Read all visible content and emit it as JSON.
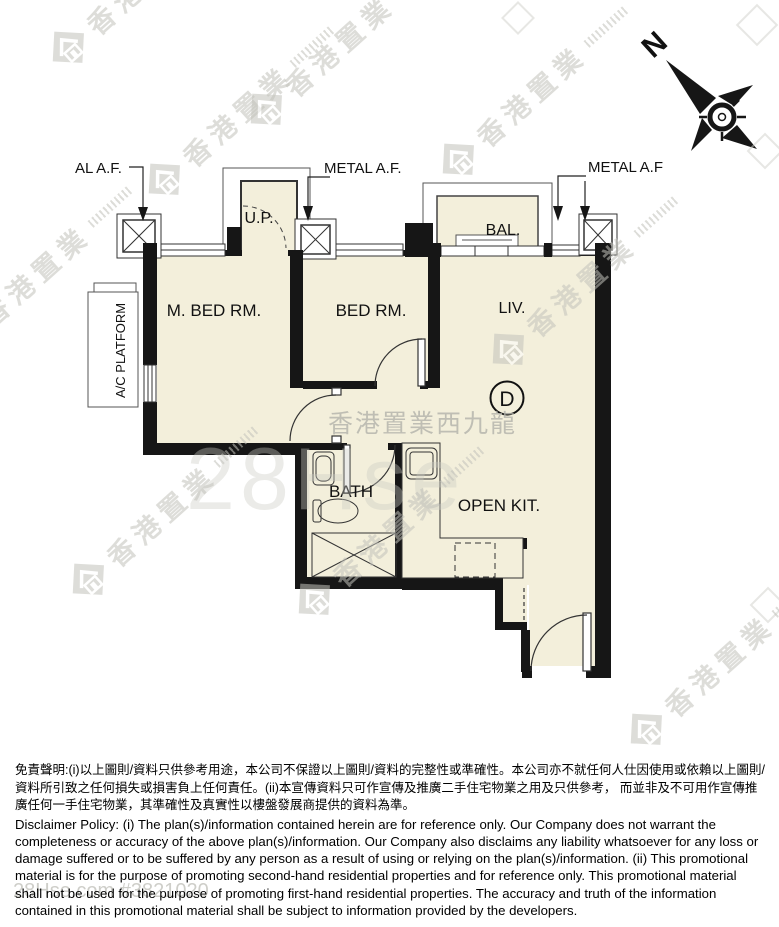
{
  "plan": {
    "compass_label": "N",
    "unit_label": "D",
    "labels": {
      "al_af": "AL A.F.",
      "metal_af_1": "METAL A.F.",
      "metal_af_2": "METAL A.F",
      "up": "U.P.",
      "bal": "BAL.",
      "m_bed": "M. BED RM.",
      "bed": "BED RM.",
      "liv": "LIV.",
      "ac_platform": "A/C PLATFORM",
      "bath": "BATH",
      "open_kit": "OPEN KIT."
    },
    "colors": {
      "floor": "#f3efdb",
      "wall": "#161616",
      "line": "#333333",
      "watermark_gray": "#c2c2bb"
    }
  },
  "watermarks": {
    "brand": "香港置業",
    "district": "香港置業西九龍",
    "ghost": "28Hse",
    "listing_id": "28Hse.com #3821020"
  },
  "disclaimer": {
    "zh": "免責聲明:(i)以上圖則/資料只供參考用途，本公司不保證以上圖則/資料的完整性或準確性。本公司亦不就任何人仕因使用或依賴以上圖則/資料所引致之任何損失或損害負上任何責任。(ii)本宣傳資料只可作宣傳及推廣二手住宅物業之用及只供參考， 而並非及不可用作宣傳推廣任何一手住宅物業，其準確性及真實性以樓盤發展商提供的資料為準。",
    "en": "Disclaimer Policy: (i) The plan(s)/information contained herein are for reference only. Our Company does not warrant the completeness or accuracy of the above plan(s)/information. Our Company also disclaims any liability whatsoever for any loss or damage suffered or to be suffered by any person as a result of using or relying on the plan(s)/information. (ii) This promotional material is for the purpose of promoting second-hand residential properties and for reference only. This promotional material shall not be used for the purpose of promoting first-hand residential properties. The accuracy and truth of the information contained in this promotional material shall be subject to information provided by the developers."
  }
}
